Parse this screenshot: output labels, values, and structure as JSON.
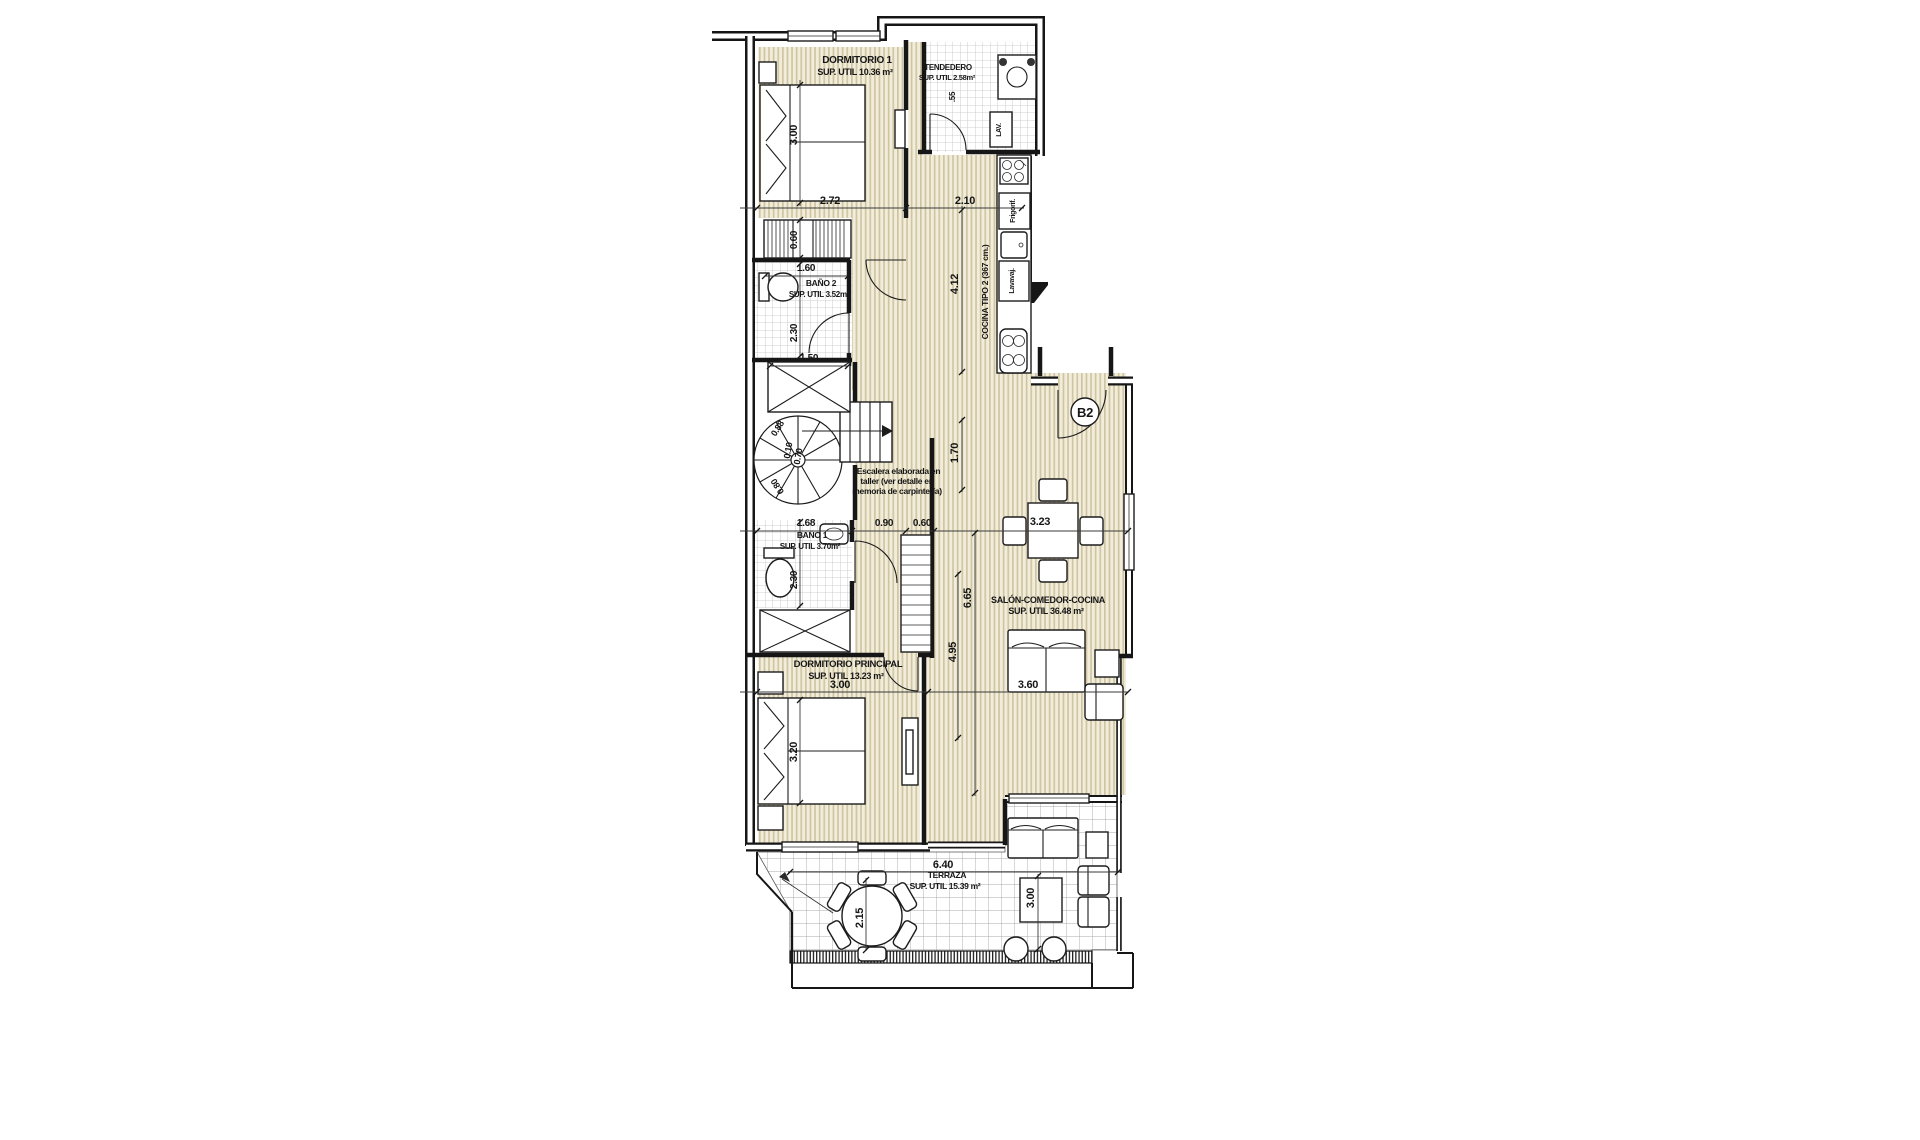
{
  "plan": {
    "unit_label": "B2",
    "rooms": [
      {
        "name": "DORMITORIO 1",
        "area_label": "SUP. UTIL 10.36 m²"
      },
      {
        "name": "TENDEDERO",
        "area_label": "SUP. UTIL 2.58m²"
      },
      {
        "name": "BAÑO 2",
        "area_label": "SUP. UTIL 3.52m²"
      },
      {
        "name": "COCINA TIPO 2 (367 cm.)",
        "area_label": ""
      },
      {
        "name": "BAÑO 1",
        "area_label": "SUP. UTIL 3.70m²"
      },
      {
        "name": "SALÓN-COMEDOR-COCINA",
        "area_label": "SUP. UTIL 36.48 m²"
      },
      {
        "name": "DORMITORIO PRINCIPAL",
        "area_label": "SUP. UTIL 13.23 m²"
      },
      {
        "name": "TERRAZA",
        "area_label": "SUP. UTIL 15.39 m²"
      }
    ],
    "stair_note": [
      "*Escalera elaborada en",
      "taller (ver detalle en",
      "memoria de carpintería)"
    ],
    "appliances": [
      "Frigorif.",
      "Lavavaj.",
      "LAV."
    ],
    "dimensions_m": [
      "2.72",
      "2.10",
      "3.00",
      "0.60",
      "1.60",
      "2.30",
      "1.50",
      "4.12",
      ".55",
      "1.70",
      "0.88",
      "0.10",
      "0.70",
      "0.80",
      "1.68",
      "0.90",
      "0.60",
      "2.30",
      "3.23",
      "6.65",
      "4.95",
      "3.00",
      "3.60",
      "3.20",
      "6.40",
      "2.15",
      "3.00"
    ],
    "colors": {
      "floor_stripe": "#cfc5a2",
      "floor_bg": "#f2eddb",
      "tile_line": "#c2c2c2",
      "terrace_tile_line": "#a9a9a9",
      "wall": "#161616",
      "dim_line": "#3a3a3a"
    },
    "texts": [
      {
        "name": "dormitorio1-label",
        "s": "DORMITORIO 1",
        "x": 857,
        "y": 63,
        "size": 10
      },
      {
        "name": "dormitorio1-area",
        "s": "SUP. UTIL 10.36 m²",
        "x": 855,
        "y": 75,
        "size": 9
      },
      {
        "name": "tendedero-label",
        "s": "TENDEDERO",
        "x": 948,
        "y": 70,
        "size": 8
      },
      {
        "name": "tendedero-area",
        "s": "SUP. UTIL 2.58m²",
        "x": 947,
        "y": 80,
        "size": 7.5
      },
      {
        "name": "bano2-label",
        "s": "BAÑO 2",
        "x": 821,
        "y": 286,
        "size": 8.5
      },
      {
        "name": "bano2-area",
        "s": "SUP. UTIL 3.52m²",
        "x": 819,
        "y": 297,
        "size": 8
      },
      {
        "name": "cocina-label",
        "s": "COCINA TIPO 2 (367 cm.)",
        "x": 988,
        "y": 292,
        "size": 8.5,
        "rot": -90
      },
      {
        "name": "frigorifico-label",
        "s": "Frigorif.",
        "x": 1015,
        "y": 211,
        "size": 7,
        "rot": -90
      },
      {
        "name": "lavavajillas-label",
        "s": "Lavavaj.",
        "x": 1014,
        "y": 281,
        "size": 7,
        "rot": -90
      },
      {
        "name": "lavadora-label",
        "s": "LAV.",
        "x": 1001,
        "y": 130,
        "size": 7,
        "rot": -90
      },
      {
        "name": "stair-note-1",
        "s": "*Escalera elaborada en",
        "x": 897,
        "y": 474,
        "size": 8.5
      },
      {
        "name": "stair-note-2",
        "s": "taller (ver detalle en",
        "x": 897,
        "y": 484,
        "size": 8.5
      },
      {
        "name": "stair-note-3",
        "s": "memoria de carpintería)",
        "x": 897,
        "y": 494,
        "size": 8.5
      },
      {
        "name": "bano1-label",
        "s": "BAÑO 1",
        "x": 812,
        "y": 538,
        "size": 8.5
      },
      {
        "name": "bano1-area",
        "s": "SUP. UTIL 3.70m²",
        "x": 810,
        "y": 549,
        "size": 8
      },
      {
        "name": "salon-label",
        "s": "SALÓN-COMEDOR-COCINA",
        "x": 1048,
        "y": 603,
        "size": 9
      },
      {
        "name": "salon-area",
        "s": "SUP. UTIL 36.48 m²",
        "x": 1046,
        "y": 614,
        "size": 9
      },
      {
        "name": "dormp-label",
        "s": "DORMITORIO PRINCIPAL",
        "x": 848,
        "y": 667,
        "size": 9.5
      },
      {
        "name": "dormp-area",
        "s": "SUP. UTIL 13.23 m²",
        "x": 846,
        "y": 679,
        "size": 9
      },
      {
        "name": "terraza-dim",
        "s": "6.40",
        "x": 943,
        "y": 868,
        "size": 11
      },
      {
        "name": "terraza-label",
        "s": "TERRAZA",
        "x": 947,
        "y": 878,
        "size": 8.5
      },
      {
        "name": "terraza-area",
        "s": "SUP. UTIL 15.39 m²",
        "x": 945,
        "y": 889,
        "size": 8.5
      },
      {
        "name": "dim",
        "s": "2.72",
        "x": 830,
        "y": 204,
        "size": 11
      },
      {
        "name": "dim",
        "s": "2.10",
        "x": 965,
        "y": 204,
        "size": 11
      },
      {
        "name": "dim",
        "s": "3.00",
        "x": 797,
        "y": 135,
        "size": 11,
        "rot": -90
      },
      {
        "name": "dim",
        "s": "0.60",
        "x": 797,
        "y": 240,
        "size": 10,
        "rot": -90
      },
      {
        "name": "dim",
        "s": "1.60",
        "x": 806,
        "y": 271,
        "size": 10
      },
      {
        "name": "dim",
        "s": "2.30",
        "x": 797,
        "y": 333,
        "size": 10,
        "rot": -90
      },
      {
        "name": "dim",
        "s": "1.50",
        "x": 809,
        "y": 361,
        "size": 10
      },
      {
        "name": "dim",
        "s": "4.12",
        "x": 958,
        "y": 284,
        "size": 11,
        "rot": -90
      },
      {
        "name": "dim",
        "s": ".55",
        "x": 955,
        "y": 97,
        "size": 8,
        "rot": -90
      },
      {
        "name": "dim",
        "s": "1.70",
        "x": 958,
        "y": 453,
        "size": 11,
        "rot": -90
      },
      {
        "name": "dim",
        "s": "0.88",
        "x": 780,
        "y": 430,
        "size": 9,
        "rot": -58
      },
      {
        "name": "dim",
        "s": "0.10",
        "x": 791,
        "y": 451,
        "size": 9,
        "rot": -80
      },
      {
        "name": "dim",
        "s": "0.70",
        "x": 801,
        "y": 457,
        "size": 9,
        "rot": -80
      },
      {
        "name": "dim",
        "s": "0.80",
        "x": 780,
        "y": 485,
        "size": 9,
        "rot": -122
      },
      {
        "name": "dim",
        "s": "1.68",
        "x": 806,
        "y": 526,
        "size": 10
      },
      {
        "name": "dim",
        "s": "0.90",
        "x": 884,
        "y": 526,
        "size": 10
      },
      {
        "name": "dim",
        "s": "0.60",
        "x": 922,
        "y": 526,
        "size": 10
      },
      {
        "name": "dim",
        "s": "2.30",
        "x": 797,
        "y": 580,
        "size": 10,
        "rot": -90
      },
      {
        "name": "dim",
        "s": "3.23",
        "x": 1040,
        "y": 525,
        "size": 11
      },
      {
        "name": "dim",
        "s": "6.65",
        "x": 971,
        "y": 598,
        "size": 11,
        "rot": -90
      },
      {
        "name": "dim",
        "s": "4.95",
        "x": 956,
        "y": 652,
        "size": 11,
        "rot": -90
      },
      {
        "name": "dim",
        "s": "3.00",
        "x": 840,
        "y": 688,
        "size": 11
      },
      {
        "name": "dim",
        "s": "3.60",
        "x": 1028,
        "y": 688,
        "size": 11
      },
      {
        "name": "dim",
        "s": "3.20",
        "x": 797,
        "y": 752,
        "size": 11,
        "rot": -90
      },
      {
        "name": "dim",
        "s": "2.15",
        "x": 863,
        "y": 918,
        "size": 11,
        "rot": -90
      },
      {
        "name": "dim",
        "s": "3.00",
        "x": 1034,
        "y": 898,
        "size": 11,
        "rot": -90
      }
    ]
  }
}
